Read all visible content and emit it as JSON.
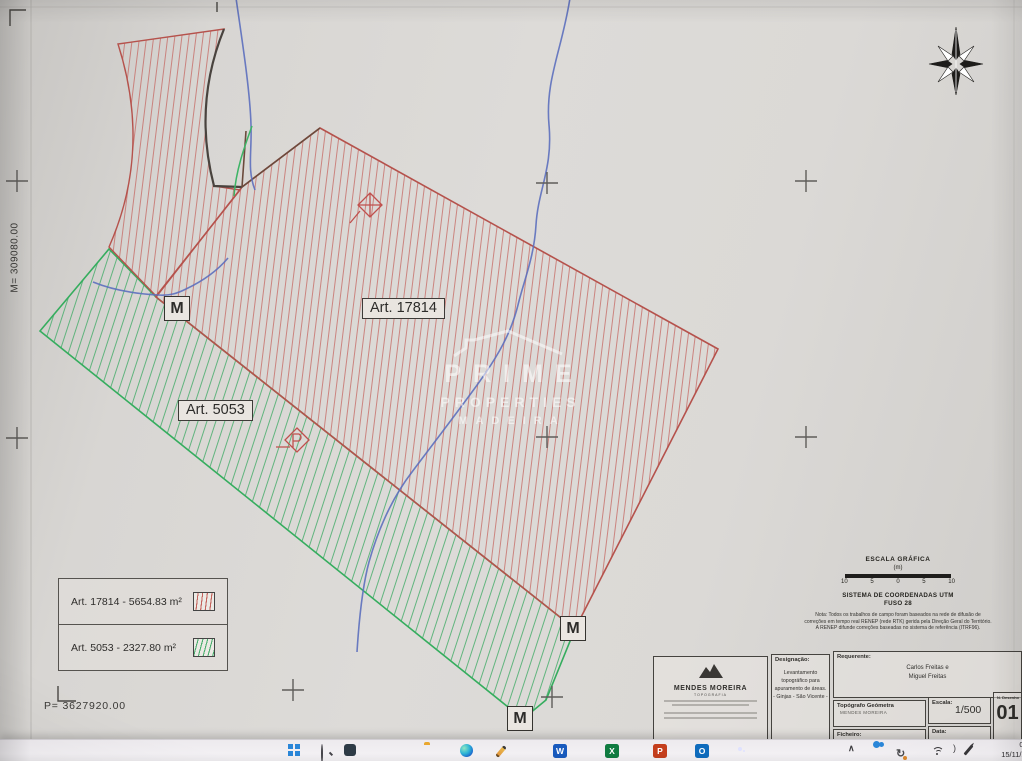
{
  "plan": {
    "axis_m": "M= 309080.00",
    "axis_p": "P= 3627920.00",
    "parcel_red_label": "Art. 17814",
    "parcel_green_label": "Art. 5053",
    "marker_label": "M",
    "colors": {
      "red_outline": "#b5524c",
      "red_hatch": "#c4635c",
      "green_outline": "#35ad5e",
      "green_hatch": "#4bae6e",
      "stream_blue": "#5c6fbe"
    }
  },
  "watermark": {
    "line1": "PRIME",
    "line2": "PROPERTIES",
    "line3": "MADEIRA"
  },
  "legend": {
    "item1": "Art. 17814 - 5654.83 m²",
    "item2": "Art. 5053 - 2327.80 m²"
  },
  "scale_block": {
    "title": "ESCALA GRÁFICA",
    "unit": "(m)",
    "ticks": [
      "10",
      "5",
      "0",
      "5",
      "10"
    ],
    "crs1": "SISTEMA DE COORDENADAS UTM",
    "crs2": "FUSO 28",
    "note1": "Nota: Todos os trabalhos de campo foram baseados na rede de difusão de",
    "note2": "correções em tempo real RENEP (rede RTK) gerida pela Direção Geral do Território.",
    "note3": "A RENEP difunde correções baseadas no sistema de referência (ITRF96)."
  },
  "title_block": {
    "company": "MENDES MOREIRA",
    "company_tag": "TOPOGRAFIA",
    "designacao_label": "Designação:",
    "designacao_1": "Levantamento",
    "designacao_2": "topográfico para",
    "designacao_3": "apuramento de áreas.",
    "designacao_4": "- Ginjas - São Vicente -",
    "requerente_label": "Requerente:",
    "requerente_1": "Carlos Freitas e",
    "requerente_2": "Miguel Freitas",
    "topografo_label": "Topógrafo Geómetra",
    "topografo_value": "MENDES MOREIRA",
    "ficheiro_label": "Ficheiro:",
    "escala_label": "Escala:",
    "escala_value": "1/500",
    "data_label": "Data:",
    "desenho_label": "N. Desenho",
    "desenho_value": "01"
  },
  "taskbar": {
    "time": "08:4",
    "date": "15/11/202",
    "office_glyphs": {
      "word": "W",
      "excel": "X",
      "powerpoint": "P",
      "outlook": "O"
    },
    "tray_glyphs": {
      "chevron": "∧",
      "sync": "↻"
    }
  }
}
